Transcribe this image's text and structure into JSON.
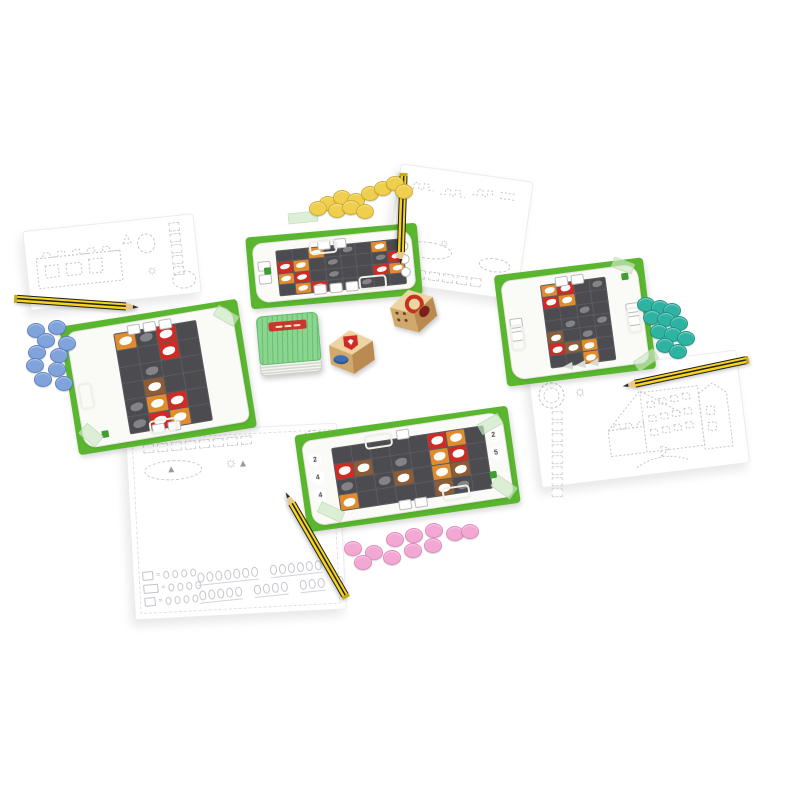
{
  "meta": {
    "description": "Product photo of a board game set on a white surface: four green player boards with dark tile grids, four score/drawing sheets with dotted castle outlines, four striped pencils, two wooden dice, a green card deck and four sets of colored disc tokens.",
    "background": "#ffffff"
  },
  "icons": {
    "sun": "☼"
  },
  "boards": {
    "mat_green": "#5ab62e",
    "paper": "#fafaf7",
    "grid_dark": "#4b4b50",
    "tile_red": "#cf2b24",
    "tile_orange": "#e08c2c",
    "tile_brown": "#8d5c34",
    "top": {
      "grid": [
        "..O.G.O.",
        "RO.G..GR",
        "OR.G..RO",
        ".OR..G.."
      ],
      "edges": {
        "top": [
          "box",
          "box"
        ],
        "bottom": [
          "box",
          "box",
          "box"
        ],
        "left": [
          "box",
          "box"
        ],
        "right": [
          "circ",
          "circ",
          "circ"
        ]
      }
    },
    "right": {
      "grid": [
        "OR.G",
        "RO..",
        "..G.",
        ".G.G",
        "B.G.",
        "RBO.",
        "..O."
      ],
      "edges": {
        "top": [
          "box",
          "box"
        ],
        "bottom": [
          "flag",
          "flag",
          "flag"
        ],
        "left": [
          "box",
          "box"
        ],
        "right": [
          "box",
          "box"
        ]
      }
    },
    "bottom": {
      "grid": [
        ".....RO.",
        "RB.G.OR.",
        "G.GB.OB.",
        "O....BG."
      ],
      "edges": {
        "top": [
          "box"
        ],
        "bottom": [
          "box",
          "box"
        ]
      },
      "shields_left": [
        "2",
        "4",
        "4"
      ],
      "shields_right": [
        "2",
        "5"
      ]
    },
    "left": {
      "grid": [
        "OGR.",
        "..R.",
        ".G..",
        ".B..",
        "GOR.",
        "GRO."
      ],
      "edges": {
        "top": [
          "box",
          "box",
          "box"
        ],
        "bottom": [
          "box",
          "box"
        ]
      }
    }
  },
  "tokens": {
    "groups": [
      {
        "name": "yellow",
        "color": "#efcf4d",
        "edge": "#d2ae2c",
        "positions": [
          [
            327,
            202
          ],
          [
            341,
            196
          ],
          [
            355,
            199
          ],
          [
            369,
            192
          ],
          [
            382,
            187
          ],
          [
            394,
            182
          ],
          [
            403,
            190
          ],
          [
            336,
            209
          ],
          [
            350,
            206
          ],
          [
            364,
            210
          ],
          [
            317,
            207
          ]
        ]
      },
      {
        "name": "blue",
        "color": "#7fa3da",
        "edge": "#5d82c2",
        "positions": [
          [
            35,
            329
          ],
          [
            56,
            326
          ],
          [
            45,
            339
          ],
          [
            66,
            342
          ],
          [
            36,
            351
          ],
          [
            58,
            354
          ],
          [
            34,
            364
          ],
          [
            56,
            368
          ],
          [
            42,
            378
          ],
          [
            63,
            382
          ]
        ]
      },
      {
        "name": "teal",
        "color": "#2eb3a2",
        "edge": "#1f9487",
        "positions": [
          [
            645,
            303
          ],
          [
            659,
            306
          ],
          [
            671,
            309
          ],
          [
            651,
            316
          ],
          [
            665,
            318
          ],
          [
            678,
            322
          ],
          [
            658,
            330
          ],
          [
            672,
            333
          ],
          [
            685,
            337
          ],
          [
            664,
            344
          ],
          [
            677,
            350
          ]
        ]
      },
      {
        "name": "pink",
        "color": "#f3a8d3",
        "edge": "#e389bf",
        "positions": [
          [
            352,
            547
          ],
          [
            373,
            551
          ],
          [
            394,
            538
          ],
          [
            413,
            534
          ],
          [
            433,
            529
          ],
          [
            454,
            532
          ],
          [
            469,
            530
          ],
          [
            362,
            561
          ],
          [
            391,
            556
          ],
          [
            412,
            549
          ],
          [
            432,
            544
          ]
        ]
      }
    ]
  },
  "dice": [
    {
      "name": "wooden-die-ring",
      "top": "red-ring",
      "left": "pips",
      "right": "dark-emblem"
    },
    {
      "name": "wooden-die-shield",
      "top": "red-shield",
      "left": "blue-oval",
      "right": "blank"
    }
  ],
  "pencils": {
    "count": 4,
    "body_color": "#f5d31e",
    "stripe_color": "#232323"
  },
  "card_deck": {
    "top_color": "#8ad68e",
    "banner_color": "#c8372b"
  },
  "sheets": {
    "paper": "#ffffff",
    "sketch_line": "#c5c5cd",
    "tracks": {
      "top_left": 5,
      "top_right": 5,
      "right": 8,
      "bottom_left": 8
    },
    "score_rows": [
      [
        7,
        6
      ],
      [
        5,
        4,
        3,
        1
      ]
    ],
    "legend_symbol": "="
  }
}
